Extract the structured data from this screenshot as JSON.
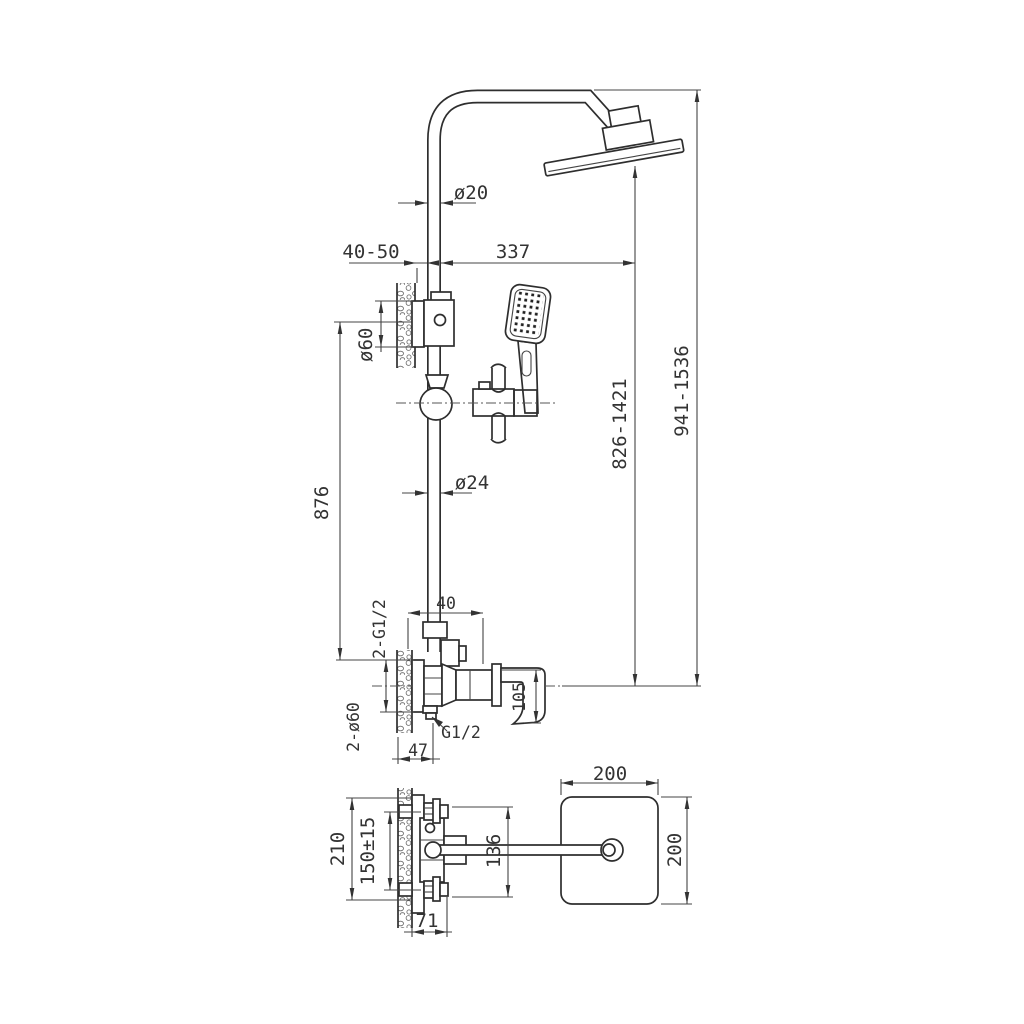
{
  "page": {
    "background": "#ffffff",
    "line_color": "#333333"
  },
  "drawing": {
    "type": "technical-drawing",
    "subject": "Shower column set with rain head, hand shower and wall mixer valve; front elevation and top view with dimensions (mm)"
  },
  "labels": {
    "riser_diameter": "ø20",
    "wall_distance": "40-50",
    "head_offset": "337",
    "bracket_escutcheon_diameter": "ø60",
    "bracket_height": "876",
    "column_diameter": "ø24",
    "head_to_valve_height": "826-1421",
    "total_height": "941-1536",
    "valve_wall_offset": "40",
    "inlet_thread": "2-G1/2",
    "handle_height": "105",
    "outlet_thread": "G1/2",
    "valve_depth": "47",
    "valve_escutcheons": "2-ø60",
    "head_width": "200",
    "head_depth": "200",
    "plate_height": "210",
    "inlet_spacing": "150±15",
    "body_height": "136",
    "protrusion": "71"
  }
}
